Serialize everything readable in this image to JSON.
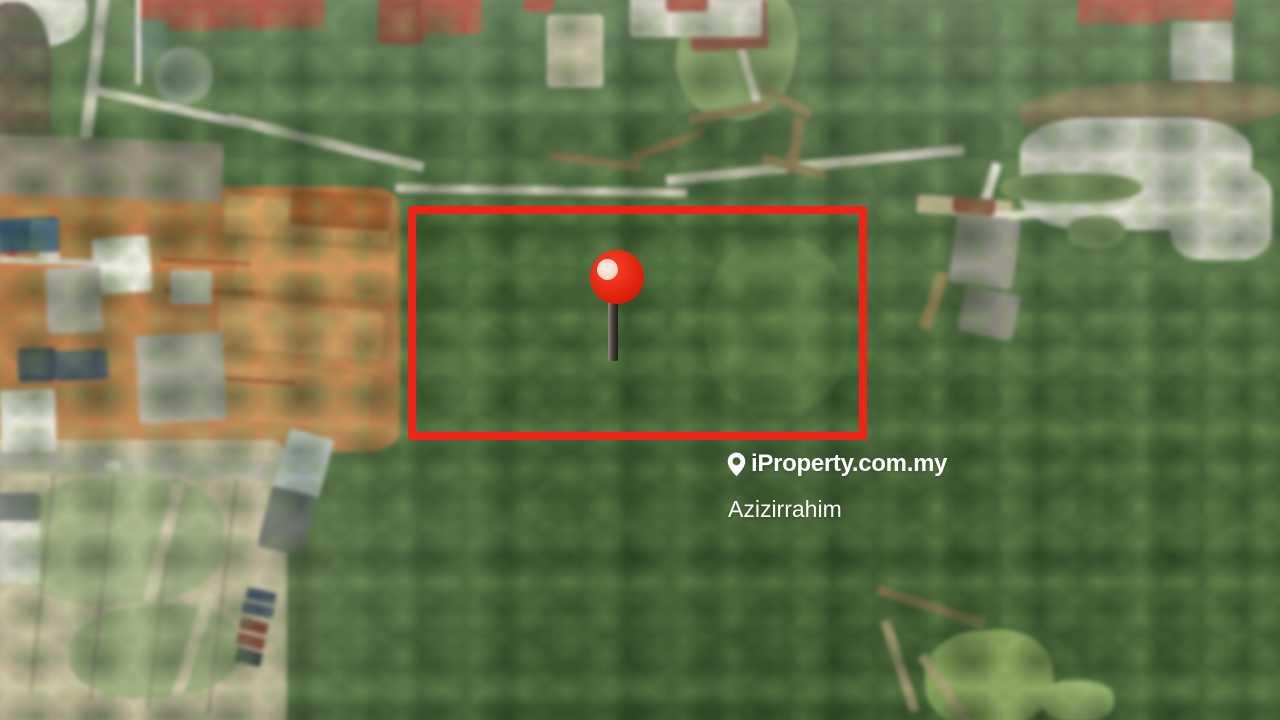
{
  "page": {
    "type": "property-listing-aerial-photo"
  },
  "photo": {
    "description": "Drone aerial view of a forested land plot beside housing construction sites",
    "regions": [
      "forest-canopy",
      "residential-houses",
      "pond",
      "construction-earthworks",
      "cleared-sandy-land",
      "warehouse",
      "parked-trucks",
      "quarry-clearing",
      "stream",
      "dirt-roads",
      "grass-field"
    ]
  },
  "overlay": {
    "boundary_box": {
      "shape": "rectangle",
      "purpose": "highlighted property boundary",
      "color": "#ee2417"
    },
    "pin": {
      "name": "red-map-pin-marker",
      "ball_color": "#e92c14",
      "stick_color": "#4a4138"
    }
  },
  "watermark": {
    "icon": "location-pin-icon",
    "brand": "iProperty.com.my",
    "agent_name": "Azizirrahim",
    "text_color": "#ffffff"
  }
}
